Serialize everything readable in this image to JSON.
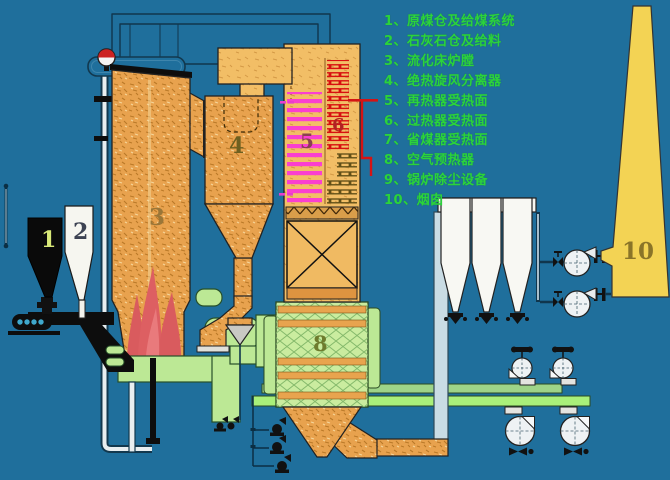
{
  "colors": {
    "background": "#1F6F9C",
    "furnace_orange": "#E8A24E",
    "backpass_orange": "#F2BE66",
    "duct_green": "#BCE895",
    "bright_duct_green": "#A9F07A",
    "flame_red": "#DD5F62",
    "reheater_coil_pink": "#FA3FD0",
    "superheater_coil_red": "#D81010",
    "chimney_yellow": "#F3D354",
    "legend_green": "#2BD33C"
  },
  "legend": {
    "items": [
      "1、原煤仓及给煤系统",
      "2、石灰石仓及给料",
      "3、流化床炉膛",
      "4、绝热旋风分离器",
      "5、再热器受热面",
      "6、过热器受热面",
      "7、省煤器受热面",
      "8、空气预热器",
      "9、锅炉除尘设备",
      "10、烟囱"
    ]
  },
  "component_labels": [
    {
      "num": "1"
    },
    {
      "num": "2"
    },
    {
      "num": "3"
    },
    {
      "num": "4"
    },
    {
      "num": "5"
    },
    {
      "num": "6"
    },
    {
      "num": "8"
    },
    {
      "num": "10"
    }
  ]
}
